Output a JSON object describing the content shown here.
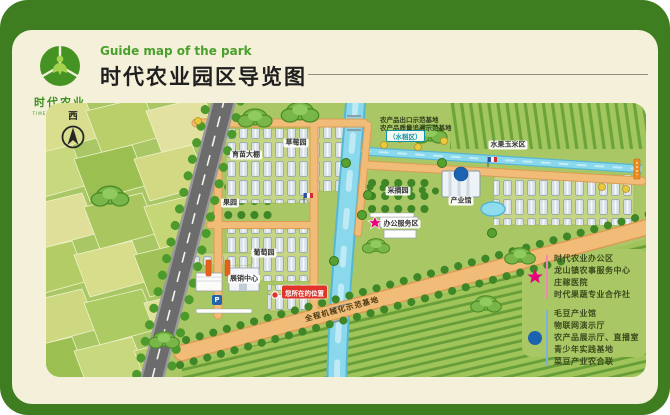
{
  "header": {
    "logo_name": "时代农业",
    "logo_caption": "TIME AGRICULTURE",
    "subtitle_en": "Guide map of the park",
    "title": "时代农业园区导览图"
  },
  "map": {
    "compass_label": "西",
    "you_are_here": "您所在的位置",
    "parking": "P",
    "labels": {
      "strawberry": "草莓园",
      "nursery": "育苗大棚",
      "orchard": "果园",
      "grape": "葡萄园",
      "exhibition": "展销中心",
      "corn": "水果玉米区",
      "hall": "产业馆",
      "office": "办公服务区",
      "picking": "采摘园",
      "rice": "（水稻区）",
      "demo1": "农产品出口示范基地",
      "demo2": "农产品质量追溯示范基地",
      "mech": "全程机械化示范基地"
    }
  },
  "legend": {
    "star_color": "#e6007e",
    "dot_color": "#1b63b0",
    "star_items": [
      "时代农业办公区",
      "龙山镇农事服务中心",
      "庄稼医院",
      "时代果蔬专业合作社"
    ],
    "dot_items": [
      "毛豆产业馆",
      "物联网演示厅",
      "农产品展示厅、直播室",
      "青少年实践基地",
      "菜豆产业农合联"
    ]
  }
}
